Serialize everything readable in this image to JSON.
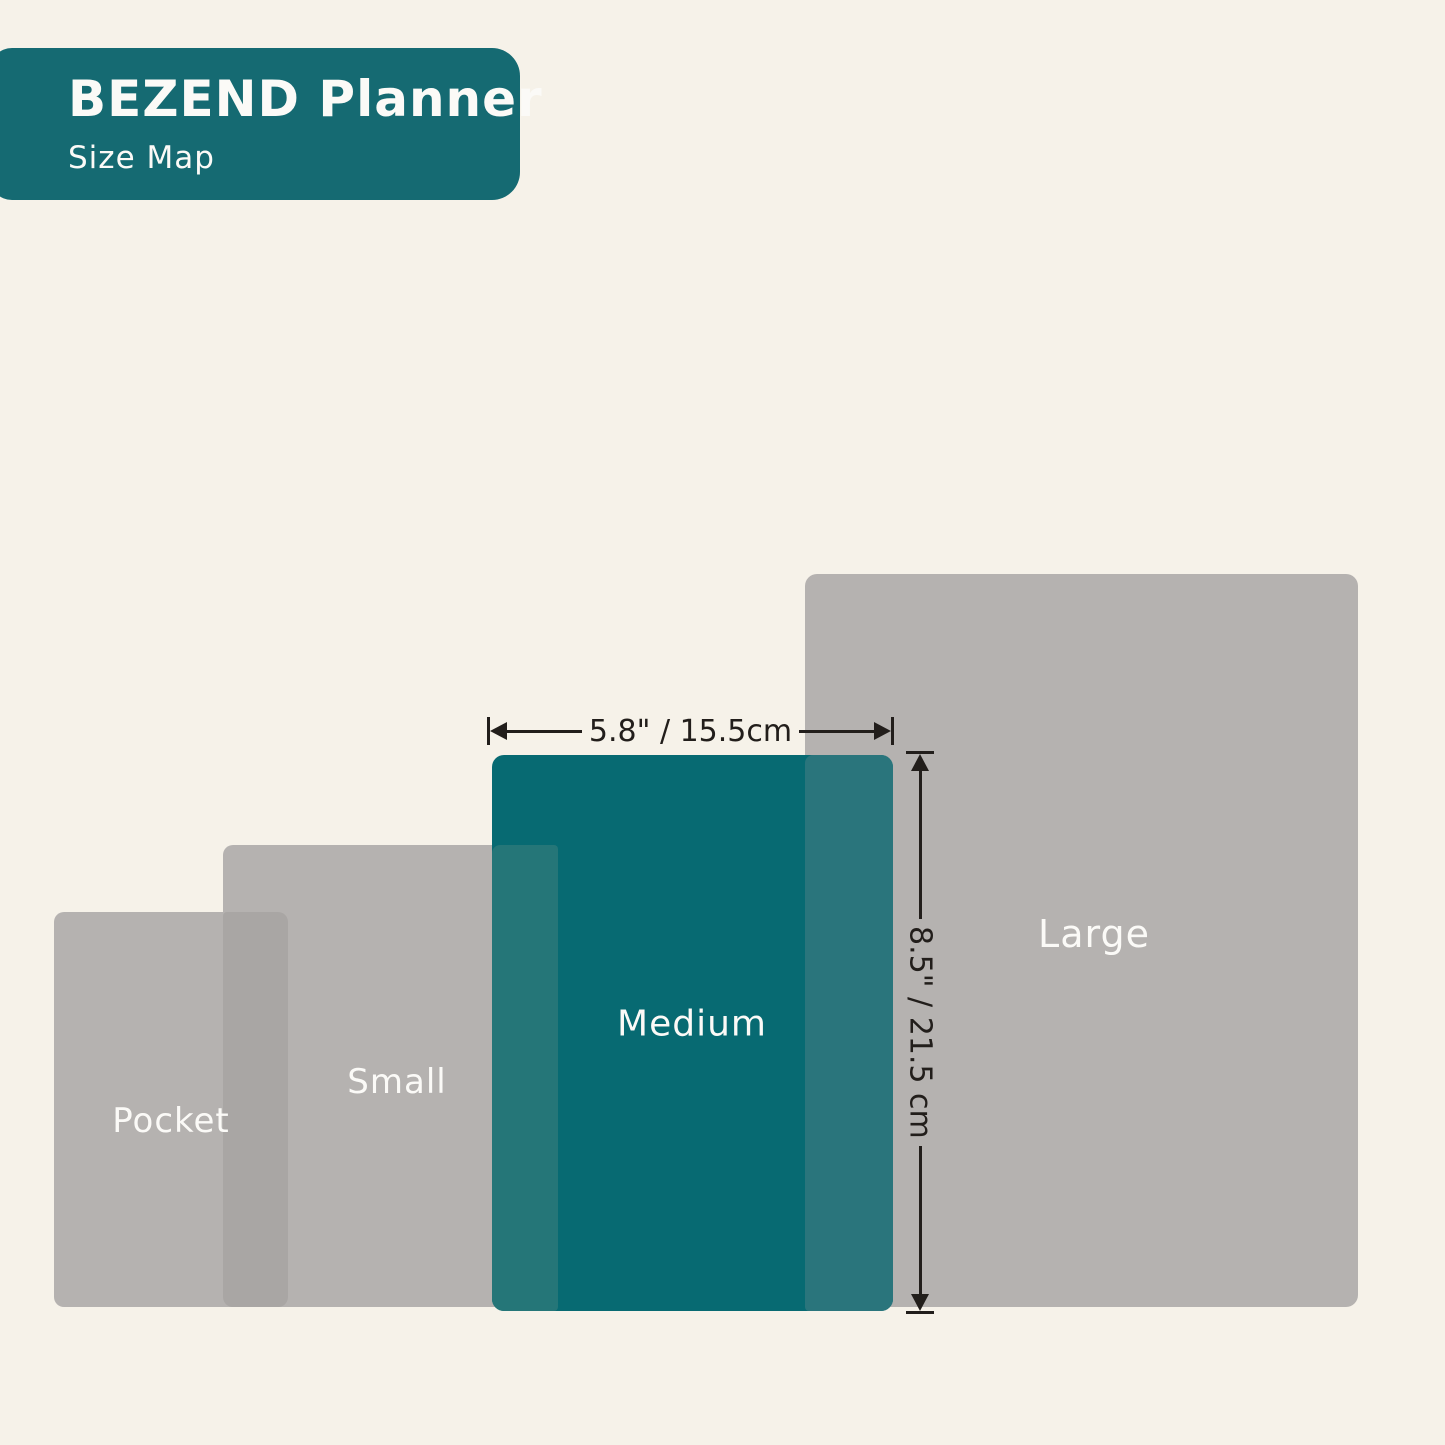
{
  "header": {
    "title": "BEZEND Planner",
    "subtitle": "Size Map"
  },
  "sizes": [
    {
      "id": "pocket",
      "label": "Pocket"
    },
    {
      "id": "small",
      "label": "Small"
    },
    {
      "id": "medium",
      "label": "Medium",
      "highlighted": true
    },
    {
      "id": "large",
      "label": "Large"
    }
  ],
  "dimensions": {
    "width_label": "5.8\" / 15.5cm",
    "height_label": "8.5\" / 21.5 cm",
    "applies_to": "Medium"
  },
  "colors": {
    "bg": "#f6f2e9",
    "header-teal": "#156a72",
    "medium-teal": "#076a72",
    "gray": "#b5b2b0",
    "gray-overlap": "#a9a6a4",
    "overlap-small-medium": "#257678",
    "overlap-medium-large": "#2a757c",
    "label-text": "#fbfaf7",
    "dimension-ink": "#221e1b"
  }
}
